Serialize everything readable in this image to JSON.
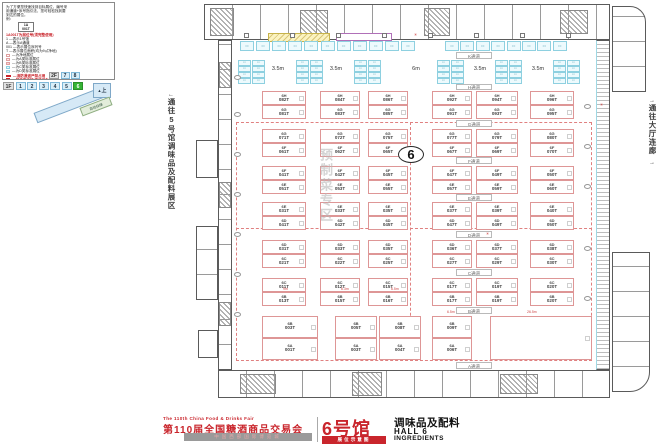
{
  "legend": {
    "intro": [
      "为了方便您快速找到目标展位，编号采",
      "用通道+序号指引法，您可轻松找到要",
      "到达的展位。",
      "例："
    ],
    "sample": {
      "line1": "1A",
      "line2": "001T"
    },
    "rule_title": "1A001T为展位号(须完整使用)",
    "rules": [
      "1 —表示1号馆",
      "A —表示A通道",
      "001 —表示展位序列号",
      "T —表示展位面积(均为9㎡净地)"
    ],
    "swatches": [
      {
        "fill": "#ffffff",
        "border": "#e0a0a0",
        "label": "—为净地展位"
      },
      {
        "fill": "#fdeaea",
        "border": "#e0a0a0",
        "label": "—为A类标准展位"
      },
      {
        "fill": "#f7d4d4",
        "border": "#e0a0a0",
        "label": "—为B类标准展位"
      },
      {
        "fill": "#eaf7fb",
        "border": "#8fd2e2",
        "label": "—为C类标准展位"
      },
      {
        "fill": "#d8eff7",
        "border": "#8fd2e2",
        "label": "—为D类标准展位"
      }
    ],
    "warnings": [
      "—消防通道严禁占用",
      "—展位内立柱 直径均为1.5m"
    ]
  },
  "floors": {
    "upper": {
      "label": "2F",
      "halls": [
        "7",
        "8"
      ]
    },
    "lower": {
      "label": "1F",
      "halls": [
        "1",
        "2",
        "3",
        "4",
        "5",
        "6"
      ],
      "active": "6"
    }
  },
  "ramp": {
    "label": "由此乘扶梯上二层7、8号馆",
    "up": "上",
    "escalator": "自动扶梯"
  },
  "corridors": {
    "left": "通往5号馆调味品及配料展区",
    "right": "通往大厅连廊"
  },
  "icons": {
    "arrow_left": "←",
    "arrow_right": "→",
    "up": "▲",
    "mark": "✳"
  },
  "map": {
    "hall_number": "6",
    "zone_watermark": "预制菜专区",
    "aisles": [
      "K通道",
      "H通道",
      "G通道",
      "F通道",
      "E通道",
      "D通道",
      "C通道",
      "B通道",
      "A通道"
    ],
    "aisle_widths": [
      "3.5m",
      "3.5m",
      "6m",
      "3.5m",
      "3.5m"
    ],
    "dims": [
      "9m",
      "6.3m",
      "6.5m",
      "6.5m",
      "26.5m"
    ],
    "cyan_rows": {
      "top_left": 11,
      "top_right": 8,
      "groups": 6,
      "group_cols": 2,
      "group_rows": 4
    },
    "bands": [
      {
        "top": [
          "6H-082T",
          "6H-084T",
          "6H-086T",
          "6H-092T",
          "6H-094T",
          "6H-096T"
        ],
        "bottom": [
          "6G-081T",
          "6G-083T",
          "6G-085T",
          "6G-091T",
          "6G-093T",
          "6G-095T"
        ]
      },
      {
        "top": [
          "6G-071T",
          "6G-072T",
          "6G-075T",
          "6G-077T",
          "6G-079T",
          "6G-080T"
        ],
        "bottom": [
          "6F-061T",
          "6F-062T",
          "6F-065T",
          "6F-067T",
          "6F-069T",
          "6F-070T"
        ]
      },
      {
        "top": [
          "6F-041T",
          "6F-042T",
          "6F-045T",
          "6F-047T",
          "6F-049T",
          "6F-050T"
        ],
        "bottom": [
          "6E-051T",
          "6E-053T",
          "6E-055T",
          "6E-057T",
          "6E-059T",
          "6E-060T"
        ]
      },
      {
        "top": [
          "6E-031T",
          "6E-033T",
          "6E-035T",
          "6E-037T",
          "6E-039T",
          "6E-040T"
        ],
        "bottom": [
          "6D-041T",
          "6D-042T",
          "6D-045T",
          "6D-047T",
          "6D-049T",
          "6D-050T"
        ]
      },
      {
        "top": [
          "6D-031T",
          "6D-033T",
          "6D-035T",
          "6D-036T",
          "6D-037T",
          "6D-038T"
        ],
        "bottom": [
          "6C-021T",
          "6C-022T",
          "6C-025T",
          "6C-027T",
          "6C-029T",
          "6C-030T"
        ]
      },
      {
        "top": [
          "6C-011T",
          "6C-012T",
          "6C-015T",
          "6C-017T",
          "6C-019T",
          "6C-020T"
        ],
        "bottom": [
          "6B-013T",
          "6B-015T",
          "6B-016T",
          "6B-017T",
          "6B-019T",
          "6B-020T"
        ]
      },
      {
        "tall": true,
        "top": [
          "6B-003T",
          "6B-005T",
          "6B-008T",
          "6B-009T"
        ],
        "bottom": [
          "6A-001T",
          "6A-003T",
          "6A-004T",
          "6A-006T"
        ]
      }
    ]
  },
  "title_block": {
    "fair_en": "The 110th China Food & Drinks Fair",
    "fair_cn": "第110届全国糖酒商品交易会",
    "venue": "中国西部国际博览城",
    "hall_cn": "6号馆",
    "badge": "展位示意图",
    "category_cn": "调味品及配料",
    "hall_en": "HALL 6",
    "category_en": "INGREDIENTS"
  }
}
